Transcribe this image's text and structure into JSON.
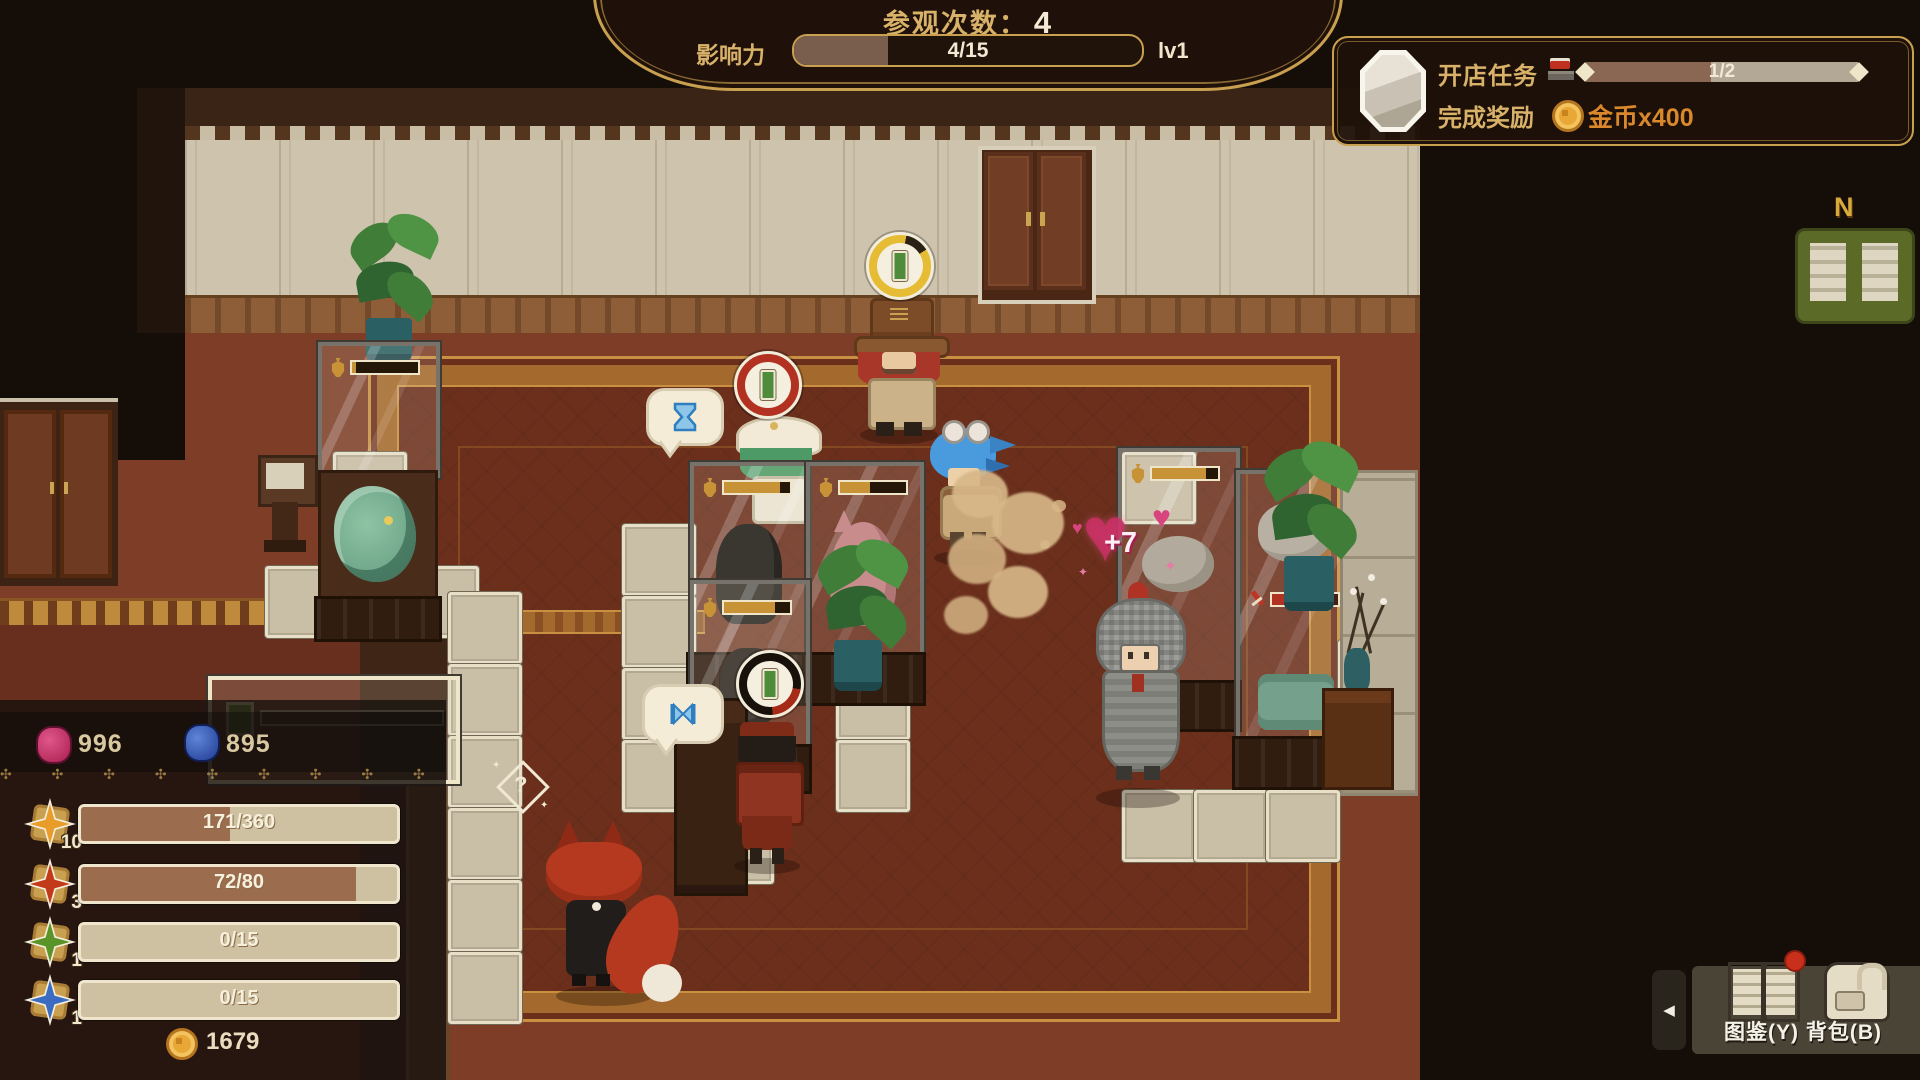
{
  "hud": {
    "banner": {
      "visits_label": "参观次数：",
      "visits_value": "4",
      "influence_label": "影响力",
      "influence_value": "4/15",
      "level_label": "lv1"
    },
    "quest": {
      "title": "开店任务",
      "progress": "1/2",
      "reward_label": "完成奖励",
      "reward_text": "金币x400"
    },
    "minimap": {
      "compass": "N"
    },
    "stats": {
      "gem_pink": "996",
      "gem_blue": "895",
      "ornaments": "✣ ✣ ✣ ✣ ✣ ✣ ✣ ✣ ✣ ✣ ✣ ✣ ✣",
      "bars": [
        {
          "level": "10",
          "text": "171/360"
        },
        {
          "level": "3",
          "text": "72/80"
        },
        {
          "level": "1",
          "text": "0/15"
        },
        {
          "level": "1",
          "text": "0/15"
        }
      ],
      "coins": "1679"
    },
    "toolbar": {
      "catalog": "图鉴(Y)",
      "bag": "背包(B)"
    }
  },
  "scene": {
    "bonus_popup": "+7",
    "question_hint": "?"
  },
  "colors": {
    "hud_gold": "#c9a050",
    "hud_text_gold": "#d9b269",
    "reward_orange": "#d9892c",
    "bar_fill": "#9c6c4f",
    "star_yellow": "#e89c2a",
    "star_red": "#c23a1a",
    "star_green": "#5a9428",
    "star_blue": "#3a6cc2",
    "gem_pink": "#c22a5e",
    "gem_blue": "#2a52b8",
    "ring_yellow": "#e6bc35",
    "ring_red": "#b23120",
    "carpet": "#6b2f1c",
    "floor": "#7d3d27",
    "wall": "#cec3ad"
  }
}
